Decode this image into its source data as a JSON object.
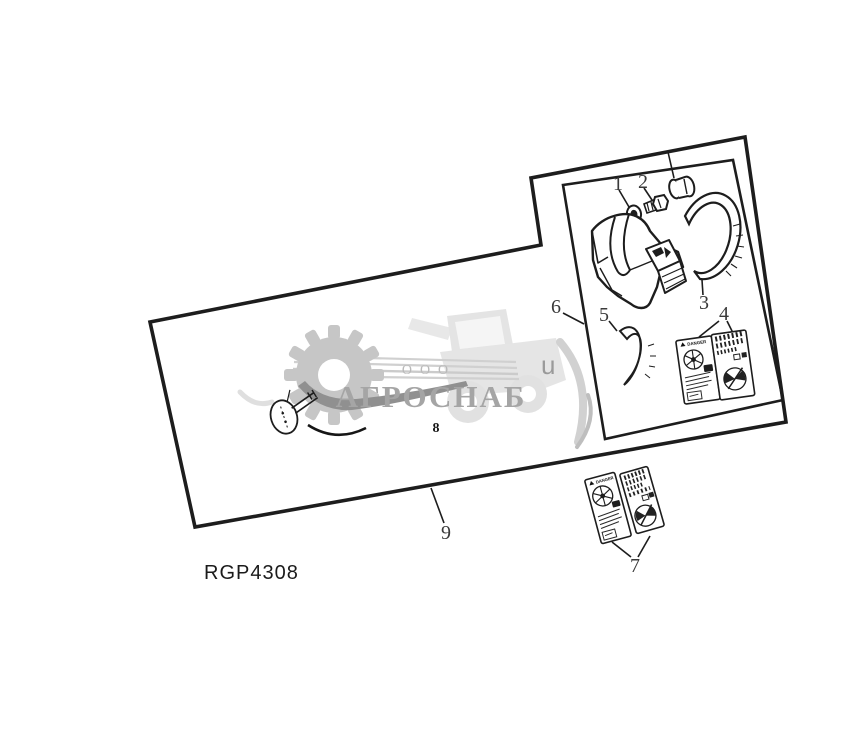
{
  "figure": {
    "code": "RGP4308",
    "callouts": {
      "c1": "1",
      "c2": "2",
      "c3": "3",
      "c4": "4",
      "c5": "5",
      "c6": "6",
      "c7": "7",
      "c8": "8",
      "c9": "9"
    }
  },
  "watermark": {
    "org_form": "ООО",
    "company": "АГРОСНАБ",
    "suffix_letter": "u"
  },
  "stickers": {
    "danger_label": "DANGER"
  },
  "colors": {
    "ink": "#1d1d1d",
    "paper": "#ffffff",
    "watermark_gray": "#a5a5a5",
    "watermark_light": "#e3e3e3"
  }
}
